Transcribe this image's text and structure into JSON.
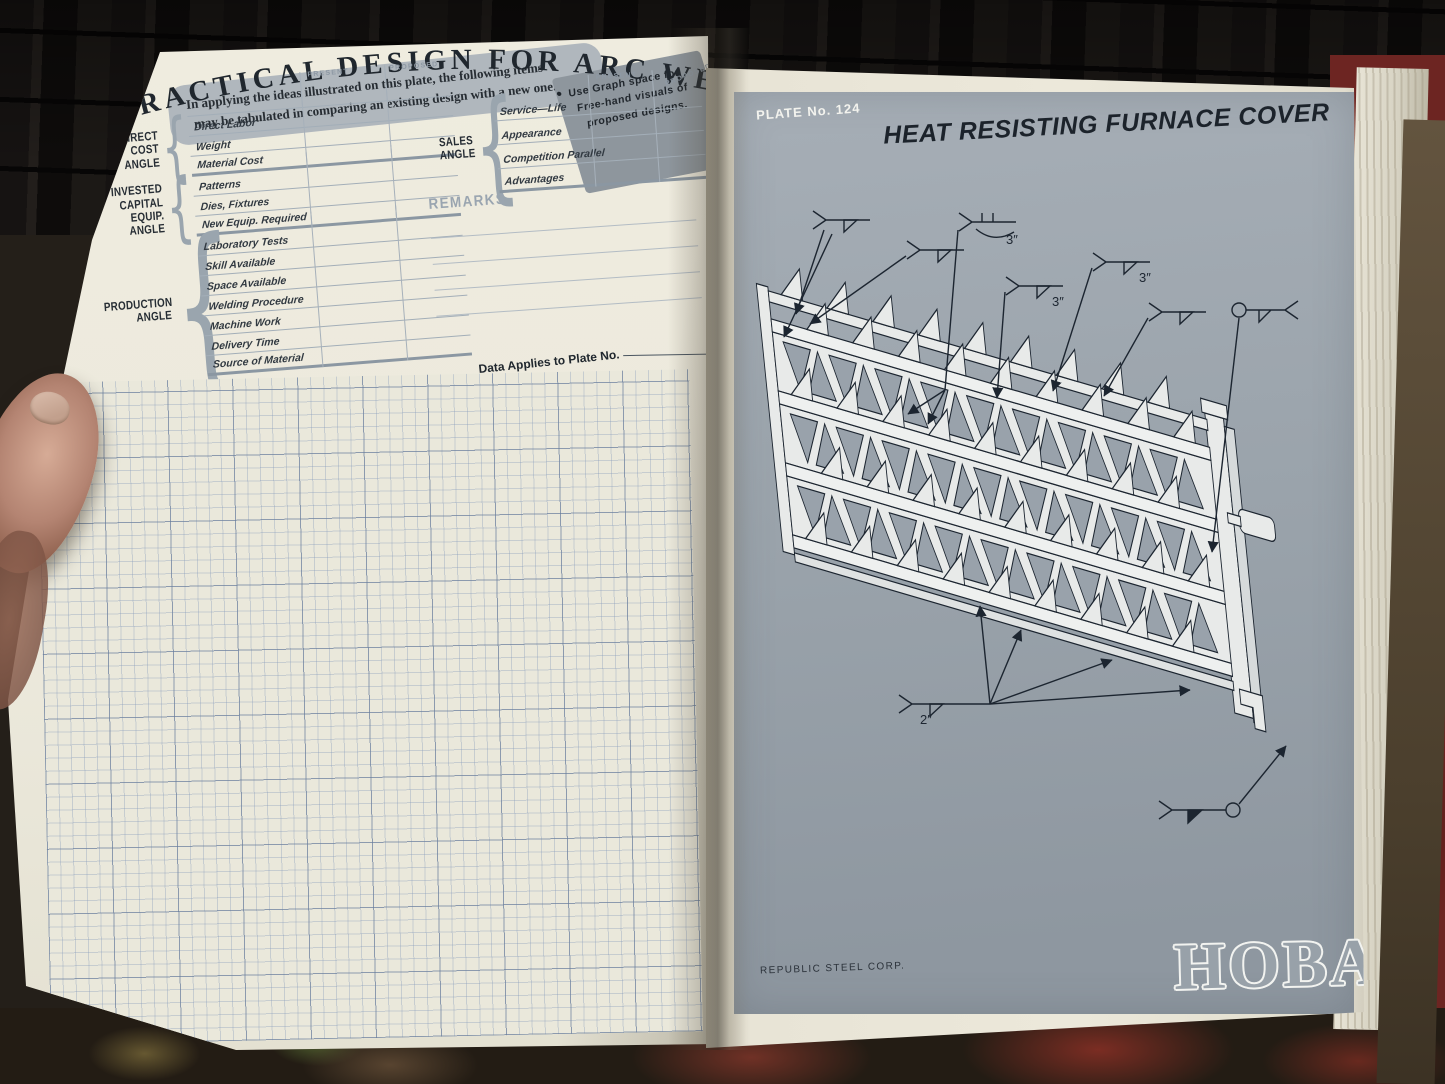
{
  "left_page": {
    "title": "PRACTICAL DESIGN FOR ARC WELDING",
    "intro_line1": "In applying the ideas illustrated on this plate, the following items",
    "intro_line2": "may be tabulated in comparing an existing design with a new one.",
    "note_bullet": "●",
    "note": [
      "Use Graph space for",
      "Free-hand visuals of",
      "proposed designs."
    ],
    "col_present": "PRESENT",
    "col_proposed": "PROPOSED",
    "groups": [
      {
        "label": [],
        "rows": [
          ""
        ]
      },
      {
        "label": [
          "DIRECT",
          "COST",
          "ANGLE"
        ],
        "rows": [
          "Direct Labor",
          "Weight",
          "Material Cost"
        ]
      },
      {
        "label": [
          "INVESTED",
          "CAPITAL",
          "EQUIP.",
          "ANGLE"
        ],
        "rows": [
          "Patterns",
          "Dies, Fixtures",
          "New Equip. Required"
        ]
      },
      {
        "label": [
          "PRODUCTION",
          "ANGLE"
        ],
        "rows": [
          "Laboratory Tests",
          "Skill Available",
          "Space Available",
          "Welding Procedure",
          "Machine Work",
          "Delivery Time",
          "Source of Material"
        ]
      }
    ],
    "sales_groups": [
      {
        "label": [
          "SALES",
          "ANGLE"
        ],
        "rows": [
          "Service—Life",
          "Appearance",
          "Competition Parallel",
          "Advantages"
        ]
      }
    ],
    "remarks_label": "REMARKS",
    "data_applies": "Data Applies to Plate No."
  },
  "right_page": {
    "plate_no": "PLATE  No. 124",
    "title": "HEAT RESISTING FURNACE COVER",
    "credit": "REPUBLIC STEEL CORP.",
    "brand": "HOBART",
    "weld_labels": [
      "3″",
      "3″",
      "3″",
      "2″"
    ]
  },
  "colors": {
    "plate_gray": "#99a2aa",
    "page_cream": "#ece9dc",
    "ink": "#1c2530",
    "grid_blue": "#687c99",
    "band_gray": "#b0b7bd",
    "fabric_red": "#6d2522"
  }
}
